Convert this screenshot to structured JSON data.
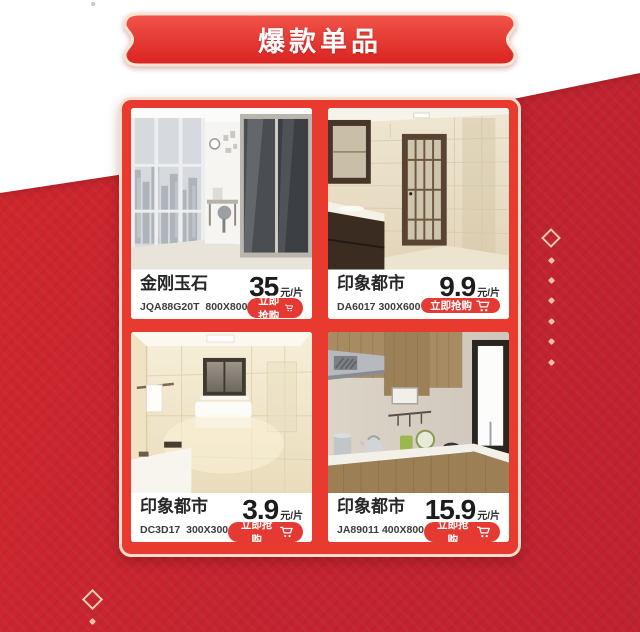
{
  "banner": {
    "title": "爆款单品"
  },
  "colors": {
    "background_red": "#c32430",
    "panel_red": "#e93a30",
    "button_red": "#e43a33",
    "border_cream": "#f7dccb",
    "decoration_gold": "#f1cdad"
  },
  "icons": {
    "cart": "shopping-cart-icon",
    "diamond": "diamond-ornament"
  },
  "products": [
    {
      "name": "金刚玉石",
      "sku": "JQA88G20T  800X800",
      "price": "35",
      "unit": "元/片",
      "cta": "立即抢购"
    },
    {
      "name": "印象都市",
      "sku": "DA6017 300X600",
      "price": "9.9",
      "unit": "元/片",
      "cta": "立即抢购"
    },
    {
      "name": "印象都市",
      "sku": "DC3D17  300X300",
      "price": "3.9",
      "unit": "元/片",
      "cta": "立即抢购"
    },
    {
      "name": "印象都市",
      "sku": "JA89011 400X800",
      "price": "15.9",
      "unit": "元/片",
      "cta": "立即抢购"
    }
  ]
}
